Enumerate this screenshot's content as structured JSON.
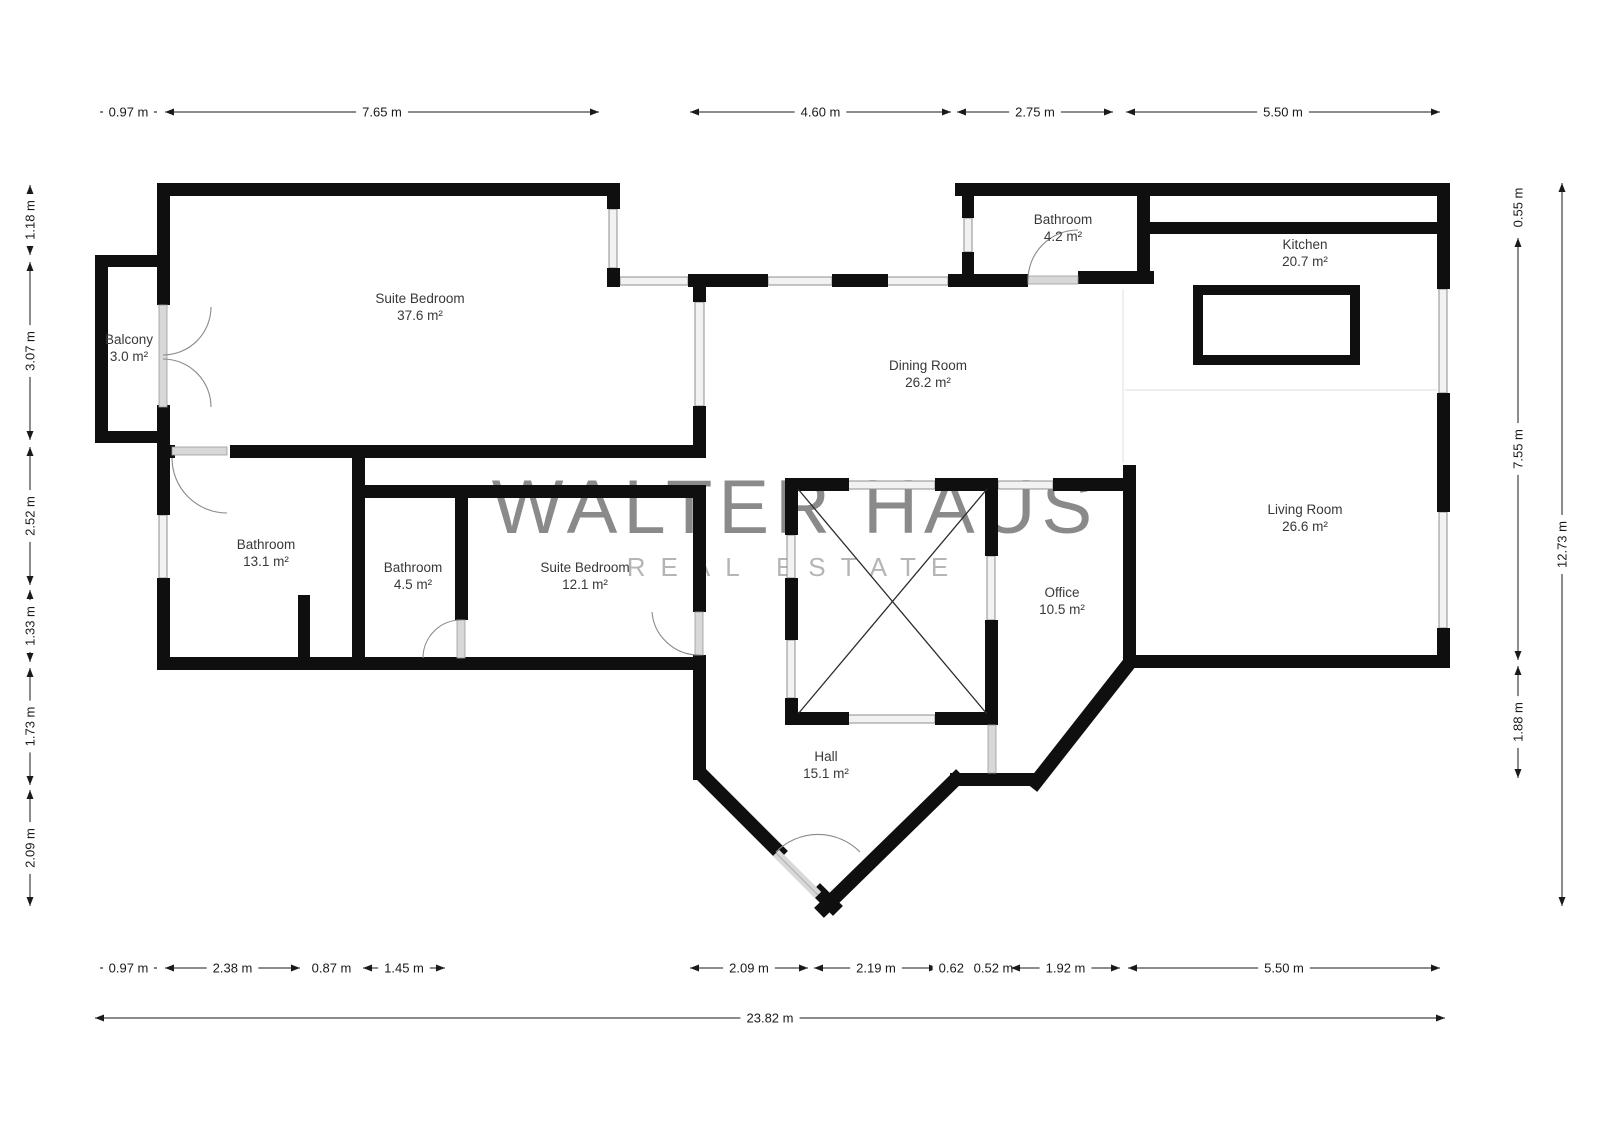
{
  "brand": {
    "name": "WALTER HAUS",
    "tagline": "REAL ESTATE"
  },
  "colors": {
    "wall": "#0f0f0f",
    "window_fill": "#f2f2f2",
    "window_edge": "#8f8f8f",
    "door_fill": "#d8d8d8",
    "door_edge": "#9a9a9a",
    "arc": "#8a8a8a",
    "faint_line": "#e4e4e4",
    "dimension": "#1a1a1a",
    "room_label": "#383838",
    "watermark": "#8a8a8a",
    "watermark_tagline": "#b5b5b5"
  },
  "floorplan": {
    "rooms": [
      {
        "name": "Suite Bedroom",
        "area": "37.6 m²",
        "x": 420,
        "y": 303
      },
      {
        "name": "Balcony",
        "area": "3.0 m²",
        "x": 129,
        "y": 344
      },
      {
        "name": "Bathroom",
        "area": "4.2 m²",
        "x": 1063,
        "y": 224
      },
      {
        "name": "Kitchen",
        "area": "20.7 m²",
        "x": 1305,
        "y": 249
      },
      {
        "name": "Dining Room",
        "area": "26.2 m²",
        "x": 928,
        "y": 370
      },
      {
        "name": "Bathroom",
        "area": "13.1 m²",
        "x": 266,
        "y": 549
      },
      {
        "name": "Bathroom",
        "area": "4.5 m²",
        "x": 413,
        "y": 572
      },
      {
        "name": "Suite Bedroom",
        "area": "12.1 m²",
        "x": 585,
        "y": 572
      },
      {
        "name": "Living Room",
        "area": "26.6 m²",
        "x": 1305,
        "y": 514
      },
      {
        "name": "Office",
        "area": "10.5 m²",
        "x": 1062,
        "y": 597
      },
      {
        "name": "Hall",
        "area": "15.1 m²",
        "x": 826,
        "y": 761
      }
    ],
    "dimensions": [
      {
        "label": "0.97 m",
        "orient": "h",
        "a": 100,
        "b": 157,
        "pos": 112
      },
      {
        "label": "7.65 m",
        "orient": "h",
        "a": 165,
        "b": 599,
        "pos": 112
      },
      {
        "label": "4.60 m",
        "orient": "h",
        "a": 690,
        "b": 951,
        "pos": 112
      },
      {
        "label": "2.75 m",
        "orient": "h",
        "a": 957,
        "b": 1113,
        "pos": 112
      },
      {
        "label": "5.50 m",
        "orient": "h",
        "a": 1126,
        "b": 1440,
        "pos": 112
      },
      {
        "label": "1.18 m",
        "orient": "v",
        "a": 185,
        "b": 255,
        "pos": 30
      },
      {
        "label": "3.07 m",
        "orient": "v",
        "a": 262,
        "b": 440,
        "pos": 30
      },
      {
        "label": "2.52 m",
        "orient": "v",
        "a": 447,
        "b": 585,
        "pos": 30
      },
      {
        "label": "1.33 m",
        "orient": "v",
        "a": 590,
        "b": 662,
        "pos": 30
      },
      {
        "label": "1.73 m",
        "orient": "v",
        "a": 668,
        "b": 785,
        "pos": 30
      },
      {
        "label": "2.09 m",
        "orient": "v",
        "a": 790,
        "b": 906,
        "pos": 30
      },
      {
        "label": "0.55 m",
        "orient": "v",
        "a": 183,
        "b": 232,
        "pos": 1518
      },
      {
        "label": "7.55 m",
        "orient": "v",
        "a": 238,
        "b": 660,
        "pos": 1518
      },
      {
        "label": "1.88 m",
        "orient": "v",
        "a": 666,
        "b": 778,
        "pos": 1518
      },
      {
        "label": "12.73 m",
        "orient": "v",
        "a": 183,
        "b": 906,
        "pos": 1562
      },
      {
        "label": "0.97 m",
        "orient": "h",
        "a": 100,
        "b": 157,
        "pos": 968
      },
      {
        "label": "2.38 m",
        "orient": "h",
        "a": 165,
        "b": 300,
        "pos": 968
      },
      {
        "label": "0.87 m",
        "orient": "h",
        "a": 307,
        "b": 356,
        "pos": 968
      },
      {
        "label": "1.45 m",
        "orient": "h",
        "a": 363,
        "b": 445,
        "pos": 968
      },
      {
        "label": "2.09 m",
        "orient": "h",
        "a": 690,
        "b": 808,
        "pos": 968
      },
      {
        "label": "2.19 m",
        "orient": "h",
        "a": 814,
        "b": 938,
        "pos": 968
      },
      {
        "label": "0.62 m",
        "orient": "h",
        "a": 941,
        "b": 976,
        "pos": 968
      },
      {
        "label": "0.52 m",
        "orient": "h",
        "a": 979,
        "b": 1008,
        "pos": 968
      },
      {
        "label": "1.92 m",
        "orient": "h",
        "a": 1011,
        "b": 1120,
        "pos": 968
      },
      {
        "label": "5.50 m",
        "orient": "h",
        "a": 1128,
        "b": 1440,
        "pos": 968
      },
      {
        "label": "23.82 m",
        "orient": "h",
        "a": 95,
        "b": 1445,
        "pos": 1018
      }
    ]
  }
}
